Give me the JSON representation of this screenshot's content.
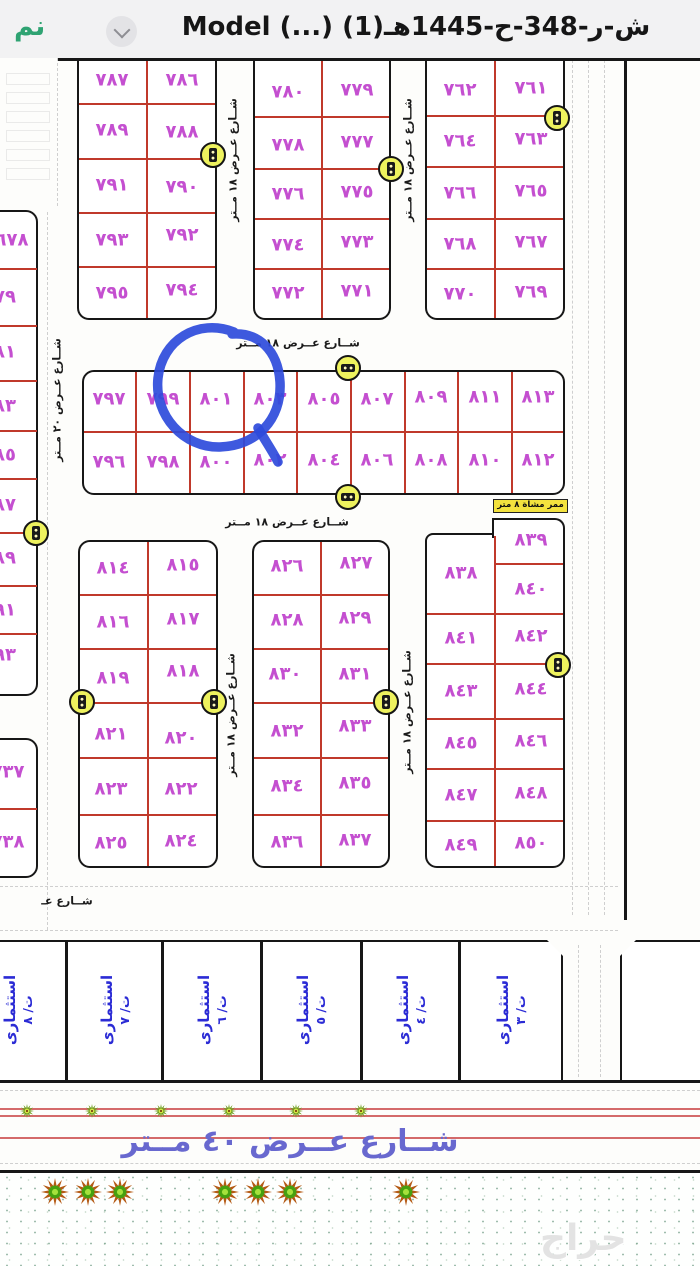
{
  "header": {
    "logo": "نم",
    "title": "ش-ر-348-ح-1445هـ(1) (...) Model"
  },
  "map": {
    "streets": {
      "w18": "شــارع عــرض ١٨ مــتر",
      "w20": "شــارع عــرض ٢٠ مــتر",
      "w40": "شــارع عــرض ٤٠ مــتر",
      "partial": "شــارع عـ",
      "walkway": "ممر مشاة ٨ متر"
    },
    "blocks": {
      "a": {
        "rows": [
          [
            "٧٨٧",
            "٧٨٦"
          ],
          [
            "٧٨٩",
            "٧٨٨"
          ],
          [
            "٧٩١",
            "٧٩٠"
          ],
          [
            "٧٩٣",
            "٧٩٢"
          ],
          [
            "٧٩٥",
            "٧٩٤"
          ]
        ]
      },
      "b": {
        "rows": [
          [
            "٧٨٠",
            "٧٧٩"
          ],
          [
            "٧٧٨",
            "٧٧٧"
          ],
          [
            "٧٧٦",
            "٧٧٥"
          ],
          [
            "٧٧٤",
            "٧٧٣"
          ],
          [
            "٧٧٢",
            "٧٧١"
          ]
        ]
      },
      "c": {
        "rows": [
          [
            "٧٦٢",
            "٧٦١"
          ],
          [
            "٧٦٤",
            "٧٦٣"
          ],
          [
            "٧٦٦",
            "٧٦٥"
          ],
          [
            "٧٦٨",
            "٧٦٧"
          ],
          [
            "٧٧٠",
            "٧٦٩"
          ]
        ]
      },
      "row_block": {
        "top": [
          "٧٩٧",
          "٧٩٩",
          "٨٠١",
          "٨٠٣",
          "٨٠٥",
          "٨٠٧",
          "٨٠٩",
          "٨١١",
          "٨١٣"
        ],
        "bottom": [
          "٧٩٦",
          "٧٩٨",
          "٨٠٠",
          "٨٠٢",
          "٨٠٤",
          "٨٠٦",
          "٨٠٨",
          "٨١٠",
          "٨١٢"
        ]
      },
      "d": {
        "rows": [
          [
            "٨١٤",
            "٨١٥"
          ],
          [
            "٨١٦",
            "٨١٧"
          ],
          [
            "٨١٩",
            "٨١٨"
          ],
          [
            "٨٢١",
            "٨٢٠"
          ],
          [
            "٨٢٣",
            "٨٢٢"
          ],
          [
            "٨٢٥",
            "٨٢٤"
          ]
        ]
      },
      "e": {
        "rows": [
          [
            "٨٢٦",
            "٨٢٧"
          ],
          [
            "٨٢٨",
            "٨٢٩"
          ],
          [
            "٨٣٠",
            "٨٣١"
          ],
          [
            "٨٣٢",
            "٨٣٣"
          ],
          [
            "٨٣٤",
            "٨٣٥"
          ],
          [
            "٨٣٦",
            "٨٣٧"
          ]
        ]
      },
      "f": {
        "left_tall": "٨٣٨",
        "right_top": [
          "٨٣٩",
          "٨٤٠"
        ],
        "rows": [
          [
            "٨٤١",
            "٨٤٢"
          ],
          [
            "٨٤٣",
            "٨٤٤"
          ],
          [
            "٨٤٥",
            "٨٤٦"
          ],
          [
            "٨٤٧",
            "٨٤٨"
          ],
          [
            "٨٤٩",
            "٨٥٠"
          ]
        ]
      }
    },
    "left_strip": {
      "upper": [
        "٦٧٨",
        "٧٩",
        "٨١",
        "٨٣",
        "٨٥",
        "٨٧",
        "٨٩",
        "٩١",
        "٩٣"
      ],
      "lower": [
        "٧٣٧",
        "٧٣٨"
      ]
    },
    "commercial": {
      "label": "استثمارى",
      "units_ltr": [
        "ت/ ٨",
        "ت/ ٧",
        "ت/ ٦",
        "ت/ ٥",
        "ت/ ٤",
        "ت/ ٣"
      ]
    },
    "annotation": {
      "shape": "hand-drawn-circle",
      "around_plot": "٨٠١",
      "color": "#2e4bdb"
    },
    "watermark": "حراج",
    "colors": {
      "plot_number": "#c44fd0",
      "parcel_line": "#c0392b",
      "marker_yellow": "#eef25e",
      "investment_text": "#2b2bd5",
      "street_text_large": "#6868cf",
      "logo_green": "#2fa372"
    },
    "icons": {
      "marker": "utility-marker-icon",
      "tree_small": "small-tree-icon",
      "tree_large": "large-tree-icon",
      "chevron": "chevron-down-icon"
    }
  }
}
